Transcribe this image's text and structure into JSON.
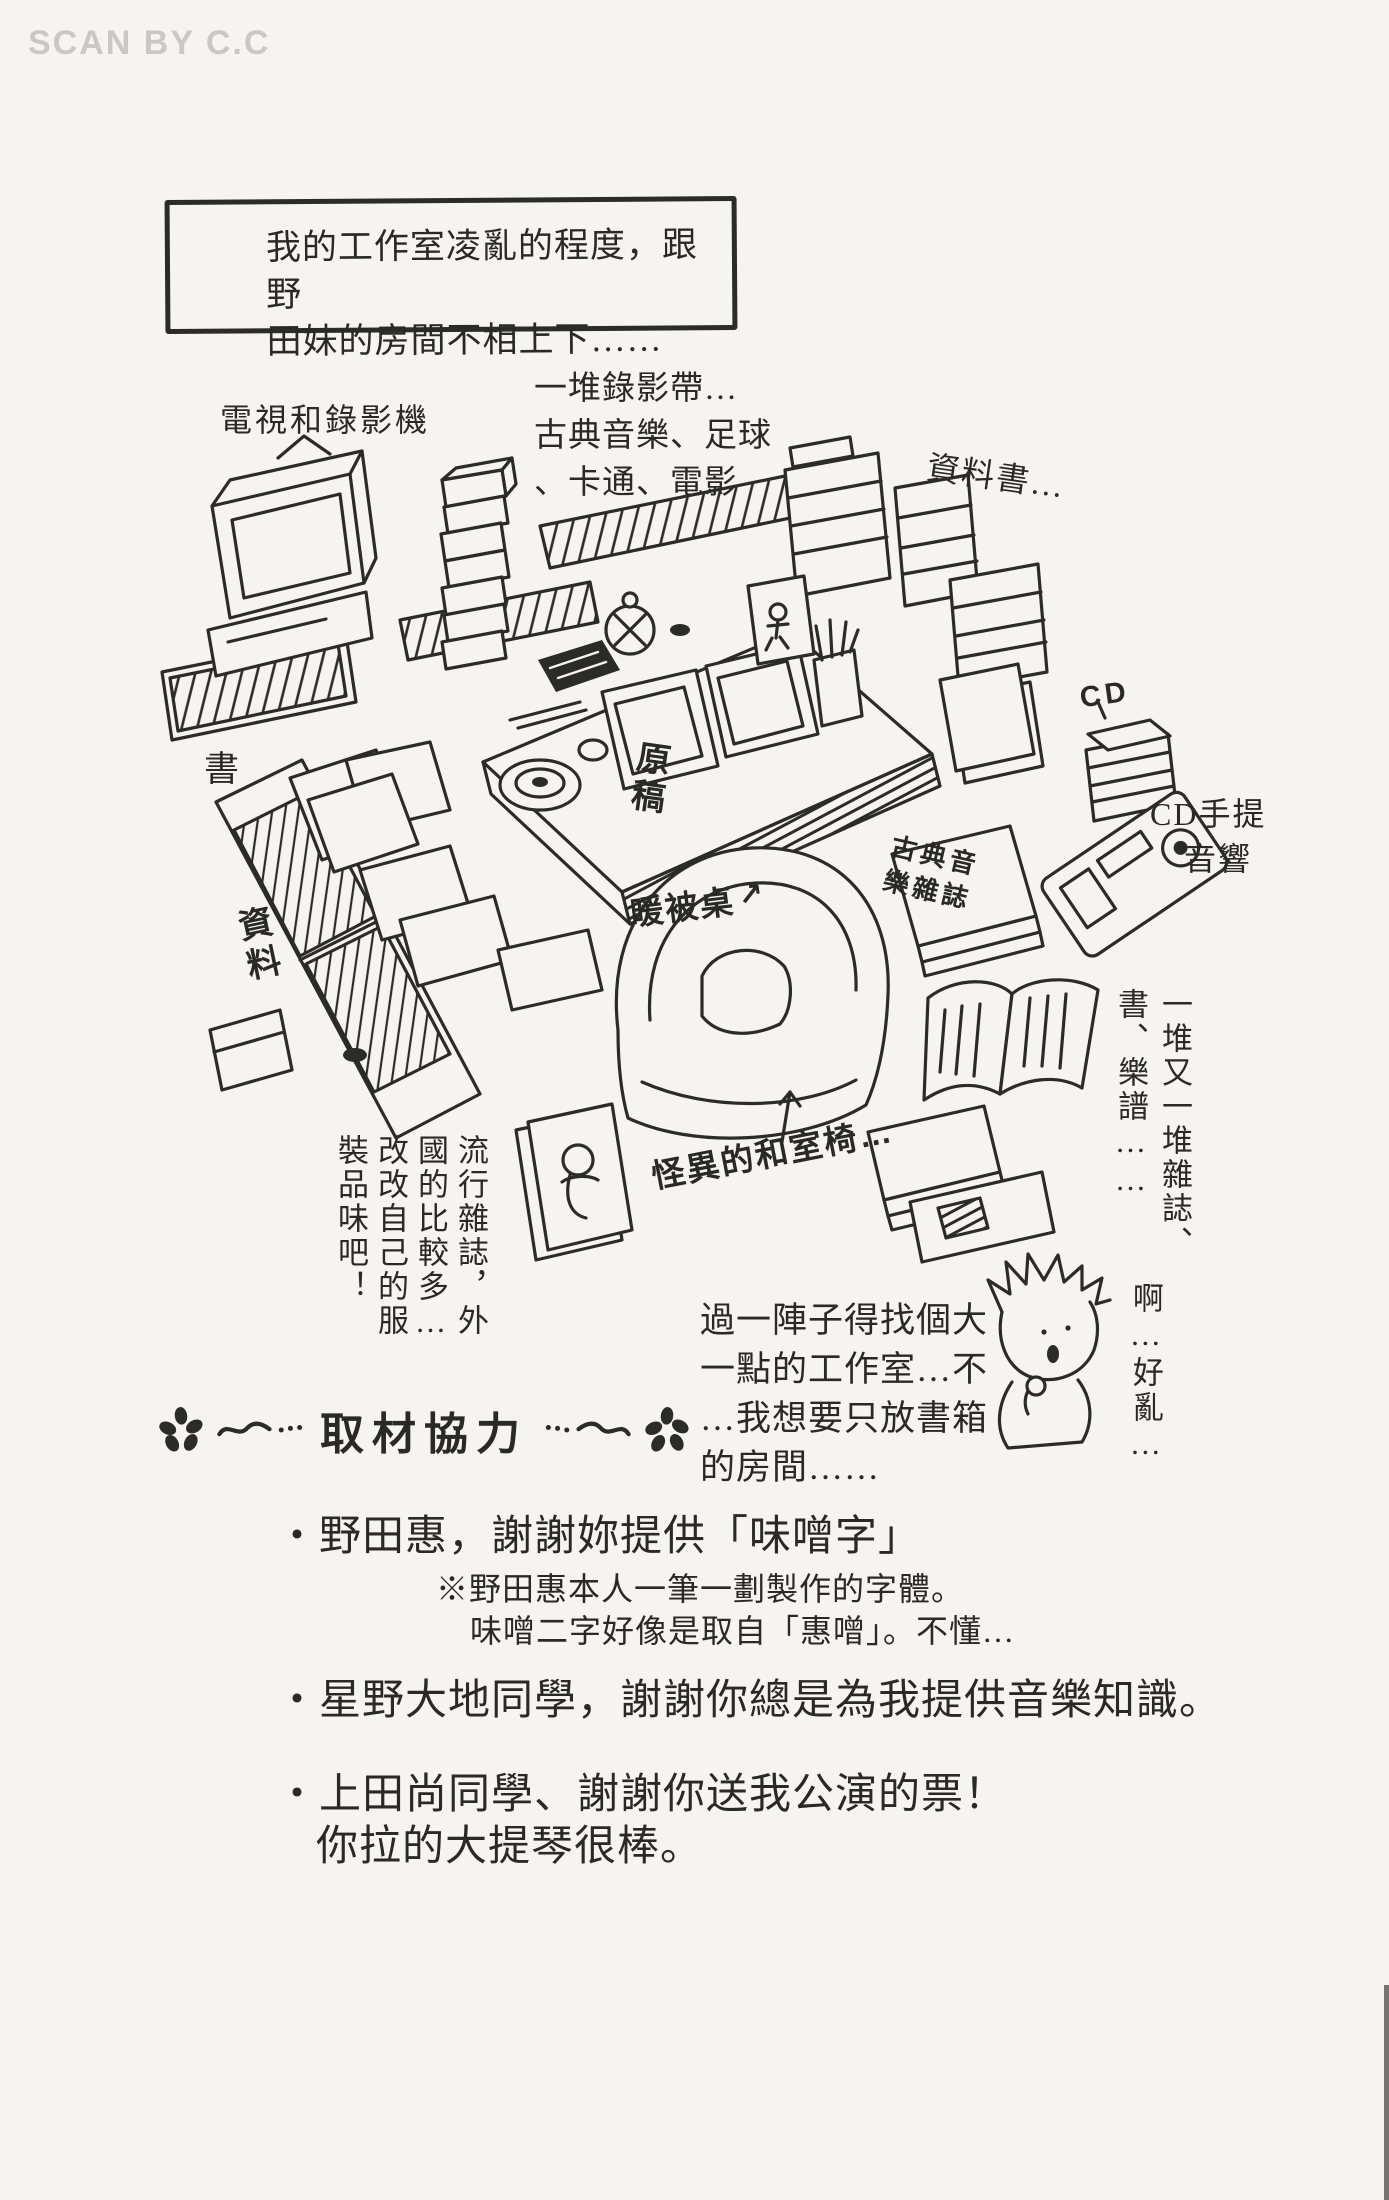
{
  "page": {
    "watermark": "SCAN BY C.C",
    "ink_color": "#2b2b28",
    "paper_color": "#f5f4f2"
  },
  "speech_box": {
    "line1": "我的工作室凌亂的程度，跟野",
    "line2": "田妹的房間不相上下……"
  },
  "labels": {
    "tv": "電視和錄影機",
    "tapes_line1": "一堆錄影帶…",
    "tapes_line2": "古典音樂、足球",
    "tapes_line3": "、卡通、電影",
    "reference_books": "資料書…",
    "books": "書",
    "reference_materials": "資料",
    "cd": "CD",
    "cd_stereo_line1": "CD手提",
    "cd_stereo_line2": "音響",
    "manuscript": "原稿",
    "kotatsu": "暖被桌",
    "kotatsu_arrow": "↗",
    "classical_magazine": "古典音樂雜誌",
    "piles": "一堆又一堆雜誌、書、樂譜……",
    "messy": "啊…好亂…",
    "chair": "怪異的和室椅…",
    "fashion": "流行雜誌，外國的比較多…改改自己的服裝品味吧！",
    "studio_line1": "過一陣子得找個大",
    "studio_line2": "一點的工作室…不",
    "studio_line3": "…我想要只放書箱",
    "studio_line4": "的房間……"
  },
  "credits": {
    "header": "取材協力",
    "item1": "・野田惠，謝謝妳提供「味噌字」",
    "item1_note1": "※野田惠本人一筆一劃製作的字體。",
    "item1_note2": "味噌二字好像是取自「惠噌」。不懂…",
    "item2": "・星野大地同學，謝謝你總是為我提供音樂知識。",
    "item3": "・上田尚同學、謝謝你送我公演的票！",
    "item3_line2": "你拉的大提琴很棒。"
  }
}
